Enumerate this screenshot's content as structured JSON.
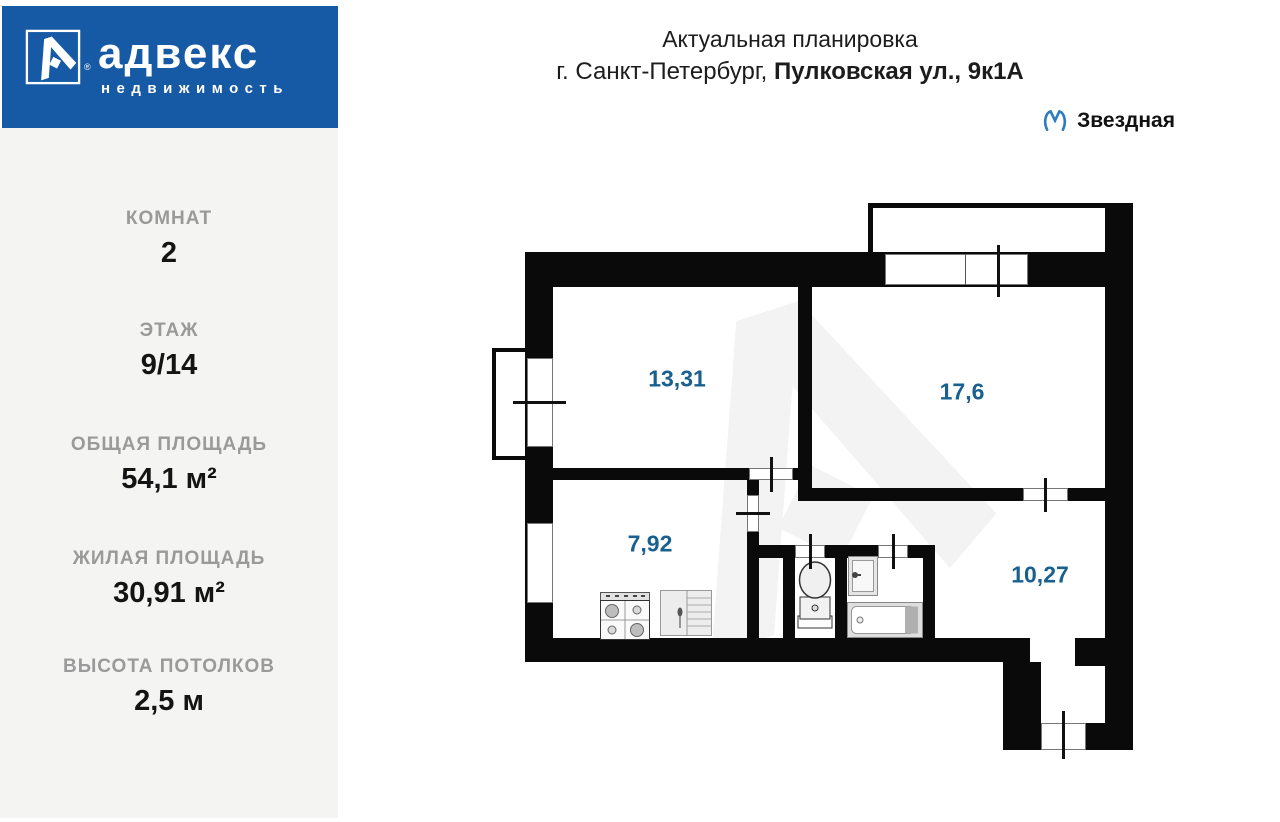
{
  "brand": {
    "name": "адвекс",
    "subtitle": "недвижимость",
    "reg": "®",
    "bg_color": "#1659a5"
  },
  "header": {
    "title": "Актуальная планировка",
    "address_prefix": "г. Санкт-Петербург, ",
    "address_bold": "Пулковская ул., 9к1А",
    "metro": {
      "station": "Звездная",
      "icon_color": "#2e7cc0"
    }
  },
  "sidebar": {
    "bg_color": "#f4f4f3",
    "stats": [
      {
        "label": "КОМНАТ",
        "value": "2"
      },
      {
        "label": "ЭТАЖ",
        "value": "9/14"
      },
      {
        "label": "ОБЩАЯ ПЛОЩАДЬ",
        "value": "54,1 м²"
      },
      {
        "label": "ЖИЛАЯ ПЛОЩАДЬ",
        "value": "30,91 м²"
      },
      {
        "label": "ВЫСОТА ПОТОЛКОВ",
        "value": "2,5 м"
      }
    ]
  },
  "plan": {
    "label_color": "#19608f",
    "wall_color": "#0a0a0a",
    "rooms": [
      {
        "name": "room-1",
        "area": "13,31"
      },
      {
        "name": "room-2",
        "area": "17,6"
      },
      {
        "name": "kitchen",
        "area": "7,92"
      },
      {
        "name": "hallway",
        "area": "10,27"
      }
    ],
    "fixtures": [
      "stove-icon",
      "cabinet-icon",
      "toilet-icon",
      "sink-icon",
      "bathtub-icon"
    ]
  }
}
